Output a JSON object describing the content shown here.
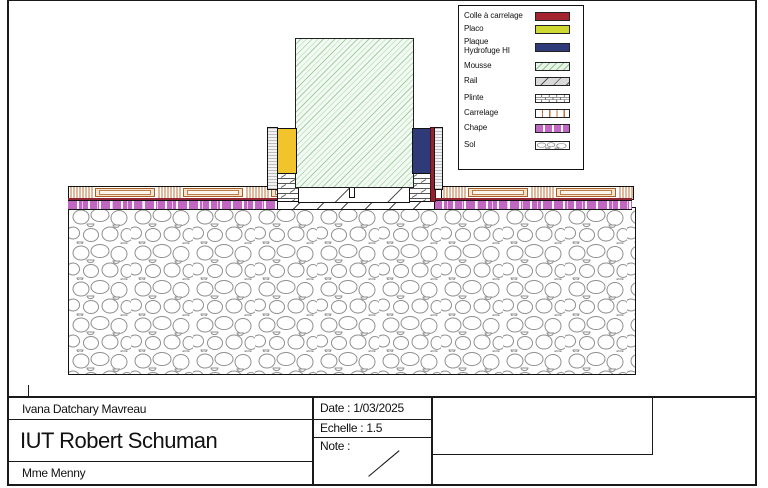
{
  "legend": {
    "items": [
      {
        "name": "colle-a-carrelage",
        "label": "Colle à carrelage",
        "color": "#a2242f"
      },
      {
        "name": "placo",
        "label": "Placo",
        "color": "#cdd931"
      },
      {
        "name": "plaque-hydrofuge",
        "label": "Plaque Hydrofuge HI",
        "color": "#2e3b78"
      },
      {
        "name": "mousse",
        "label": "Mousse",
        "color": "#eaf5ea"
      },
      {
        "name": "rail",
        "label": "Rail",
        "color": "#d9d9d9"
      },
      {
        "name": "plinte",
        "label": "Plinte",
        "color": "#ffffff"
      },
      {
        "name": "carrelage",
        "label": "Carrelage",
        "color": "#c4703a"
      },
      {
        "name": "chape",
        "label": "Chape",
        "color": "#c167c1"
      },
      {
        "name": "sol",
        "label": "Sol",
        "color": "#ffffff"
      }
    ]
  },
  "title_block": {
    "author": "Ivana Datchary Mavreau",
    "institution": "IUT Robert Schuman",
    "supervisor": "Mme Menny",
    "date": "Date : 1/03/2025",
    "scale": "Echelle : 1.5",
    "note": "Note :"
  },
  "drawing": {
    "type": "construction-detail-section",
    "materials_colors": {
      "colle_a_carrelage": "#8e2430",
      "placo_wall_block": "#f0c42a",
      "plaque_hydrofuge": "#2e3b78",
      "mousse_hatch": "#8cbe8c",
      "chape": "#c167c1",
      "carrelage_lines": "#c4703a"
    }
  }
}
